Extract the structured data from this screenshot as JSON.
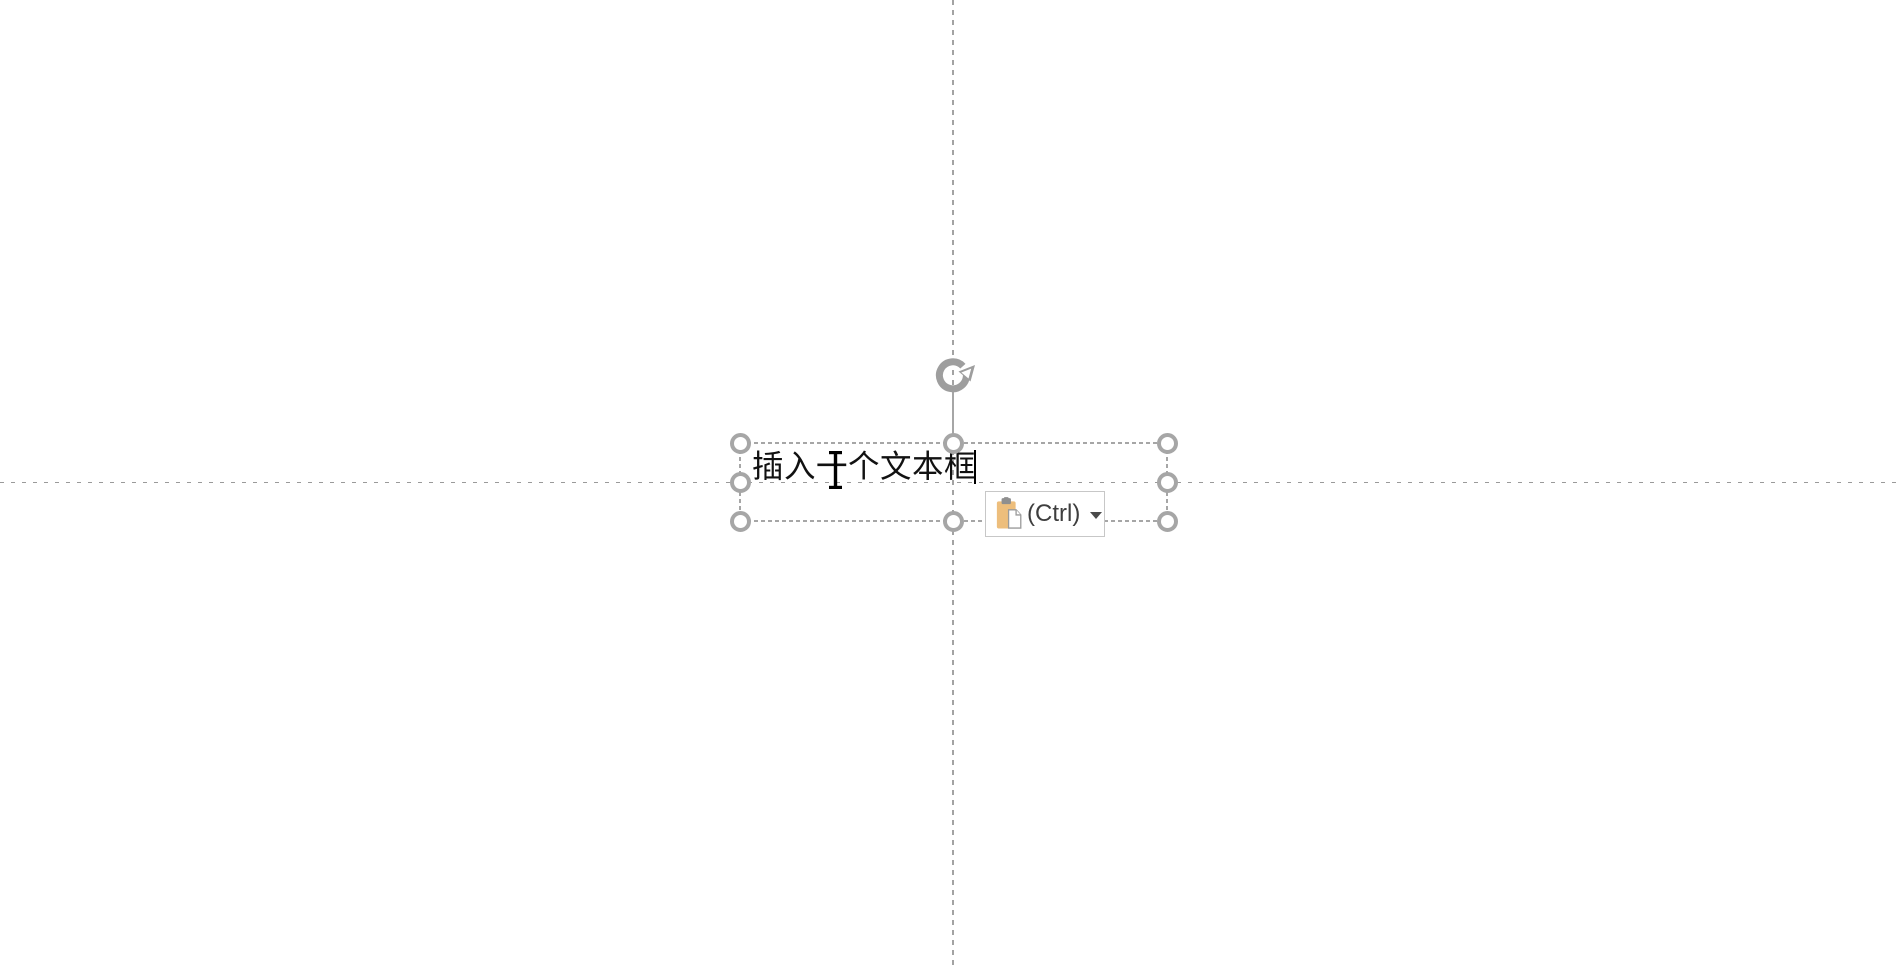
{
  "canvas": {
    "background_color": "#FFFFFF",
    "guide_color": "#A3A3A3",
    "guides": [
      "vertical-center-guide",
      "horizontal-center-guide"
    ]
  },
  "textbox": {
    "text": "插入一个文本框",
    "text_color": "#111111",
    "selection_color": "#A6A6A6",
    "handles": [
      "top-left",
      "top-center",
      "top-right",
      "middle-left",
      "middle-right",
      "bottom-left",
      "bottom-center",
      "bottom-right"
    ],
    "rotate_icon": "rotate-handle-icon",
    "caret_visible": true
  },
  "mouse_cursor": {
    "icon": "text-ibeam-cursor-icon",
    "color": "#000000"
  },
  "paste_options": {
    "label": "(Ctrl)",
    "icon": "paste-clipboard-icon",
    "dropdown_icon": "dropdown-arrow-icon",
    "clipboard_color": "#EDBE7C",
    "clip_color": "#8F8F8F",
    "border_color": "#C7C7C7",
    "label_color": "#3E3E3E"
  }
}
